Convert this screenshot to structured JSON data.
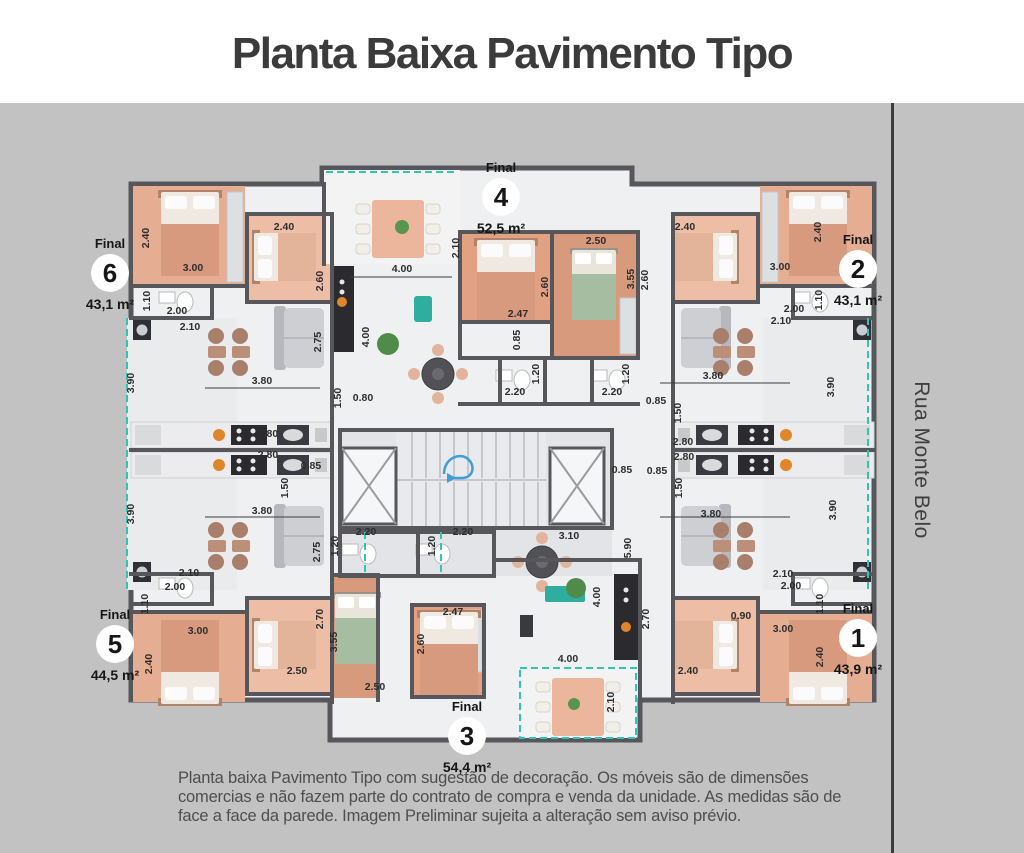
{
  "header": {
    "title": "Planta Baixa Pavimento Tipo"
  },
  "street": {
    "name": "Rua Monte Belo"
  },
  "disclaimer": {
    "text": "Planta baixa Pavimento Tipo com sugestão de decoração. Os móveis são de dimensões comercias e não fazem parte do contrato de compra e venda da unidade. As medidas são de face a face da parede. Imagem Preliminar sujeita a alteração sem aviso prévio."
  },
  "units": [
    {
      "label": "Final",
      "number": "1",
      "area": "43,9 m²"
    },
    {
      "label": "Final",
      "number": "2",
      "area": "43,1 m²"
    },
    {
      "label": "Final",
      "number": "3",
      "area": "54,4 m²"
    },
    {
      "label": "Final",
      "number": "4",
      "area": "52,5 m²"
    },
    {
      "label": "Final",
      "number": "5",
      "area": "44,5 m²"
    },
    {
      "label": "Final",
      "number": "6",
      "area": "43,1 m²"
    }
  ],
  "colors": {
    "background": "#c2c2c2",
    "header_background": "#ffffff",
    "title_text": "#3b3b3b",
    "wall": "#56565b",
    "floor": "#eef0f2",
    "bedroom_salmon": "#e5ad92",
    "dimension_teal": "#2cc6b4",
    "stairs_arrow_blue": "#3d9fd8",
    "disclaimer_text": "#4e4e4e"
  },
  "plan": {
    "dimensions": [
      {
        "t": "2.40",
        "x": 149,
        "y": 238,
        "v": true
      },
      {
        "t": "3.00",
        "x": 193,
        "y": 271
      },
      {
        "t": "2.40",
        "x": 284,
        "y": 230
      },
      {
        "t": "2.60",
        "x": 323,
        "y": 281,
        "v": true
      },
      {
        "t": "1.10",
        "x": 150,
        "y": 301,
        "v": true
      },
      {
        "t": "2.00",
        "x": 177,
        "y": 314
      },
      {
        "t": "2.10",
        "x": 190,
        "y": 330
      },
      {
        "t": "2.75",
        "x": 321,
        "y": 342,
        "v": true
      },
      {
        "t": "3.90",
        "x": 134,
        "y": 383,
        "v": true
      },
      {
        "t": "3.80",
        "x": 262,
        "y": 384
      },
      {
        "t": "0.80",
        "x": 363,
        "y": 401
      },
      {
        "t": "1.50",
        "x": 341,
        "y": 398,
        "v": true
      },
      {
        "t": "2.80",
        "x": 268,
        "y": 437
      },
      {
        "t": "2.80",
        "x": 268,
        "y": 458
      },
      {
        "t": "0.85",
        "x": 311,
        "y": 469
      },
      {
        "t": "1.50",
        "x": 288,
        "y": 488,
        "v": true
      },
      {
        "t": "3.90",
        "x": 134,
        "y": 514,
        "v": true
      },
      {
        "t": "3.80",
        "x": 262,
        "y": 514
      },
      {
        "t": "2.75",
        "x": 320,
        "y": 552,
        "v": true
      },
      {
        "t": "2.10",
        "x": 189,
        "y": 576
      },
      {
        "t": "2.00",
        "x": 175,
        "y": 590
      },
      {
        "t": "1.10",
        "x": 148,
        "y": 604,
        "v": true
      },
      {
        "t": "3.00",
        "x": 198,
        "y": 634
      },
      {
        "t": "2.40",
        "x": 152,
        "y": 664,
        "v": true
      },
      {
        "t": "2.50",
        "x": 297,
        "y": 674
      },
      {
        "t": "2.70",
        "x": 323,
        "y": 619,
        "v": true
      },
      {
        "t": "2.10",
        "x": 459,
        "y": 248,
        "v": true
      },
      {
        "t": "4.00",
        "x": 402,
        "y": 272
      },
      {
        "t": "4.00",
        "x": 369,
        "y": 337,
        "v": true
      },
      {
        "t": "2.47",
        "x": 518,
        "y": 317
      },
      {
        "t": "2.60",
        "x": 548,
        "y": 287,
        "v": true
      },
      {
        "t": "2.50",
        "x": 596,
        "y": 244
      },
      {
        "t": "3.55",
        "x": 634,
        "y": 279,
        "v": true
      },
      {
        "t": "0.85",
        "x": 520,
        "y": 340,
        "v": true
      },
      {
        "t": "1.20",
        "x": 539,
        "y": 374,
        "v": true
      },
      {
        "t": "2.20",
        "x": 515,
        "y": 395
      },
      {
        "t": "1.20",
        "x": 629,
        "y": 374,
        "v": true
      },
      {
        "t": "2.20",
        "x": 612,
        "y": 395
      },
      {
        "t": "1.20",
        "x": 338,
        "y": 546,
        "v": true
      },
      {
        "t": "2.20",
        "x": 366,
        "y": 535
      },
      {
        "t": "1.20",
        "x": 435,
        "y": 546,
        "v": true
      },
      {
        "t": "2.20",
        "x": 463,
        "y": 535
      },
      {
        "t": "3.10",
        "x": 569,
        "y": 539
      },
      {
        "t": "5.90",
        "x": 631,
        "y": 548,
        "v": true
      },
      {
        "t": "0.85",
        "x": 622,
        "y": 473
      },
      {
        "t": "4.00",
        "x": 600,
        "y": 597,
        "v": true
      },
      {
        "t": "4.00",
        "x": 568,
        "y": 662
      },
      {
        "t": "2.47",
        "x": 453,
        "y": 615
      },
      {
        "t": "2.60",
        "x": 424,
        "y": 644,
        "v": true
      },
      {
        "t": "2.50",
        "x": 375,
        "y": 690
      },
      {
        "t": "3.55",
        "x": 337,
        "y": 642,
        "v": true
      },
      {
        "t": "2.10",
        "x": 614,
        "y": 702,
        "v": true
      },
      {
        "t": "2.40",
        "x": 685,
        "y": 230
      },
      {
        "t": "2.60",
        "x": 648,
        "y": 280,
        "v": true
      },
      {
        "t": "3.00",
        "x": 780,
        "y": 270
      },
      {
        "t": "2.40",
        "x": 821,
        "y": 232,
        "v": true
      },
      {
        "t": "1.10",
        "x": 822,
        "y": 300,
        "v": true
      },
      {
        "t": "2.00",
        "x": 794,
        "y": 312
      },
      {
        "t": "2.10",
        "x": 781,
        "y": 324
      },
      {
        "t": "3.80",
        "x": 713,
        "y": 379
      },
      {
        "t": "3.90",
        "x": 834,
        "y": 387,
        "v": true
      },
      {
        "t": "0.85",
        "x": 656,
        "y": 404
      },
      {
        "t": "1.50",
        "x": 681,
        "y": 413,
        "v": true
      },
      {
        "t": "2.80",
        "x": 683,
        "y": 445
      },
      {
        "t": "2.80",
        "x": 684,
        "y": 460
      },
      {
        "t": "0.85",
        "x": 657,
        "y": 474
      },
      {
        "t": "1.50",
        "x": 682,
        "y": 488,
        "v": true
      },
      {
        "t": "3.80",
        "x": 711,
        "y": 517
      },
      {
        "t": "3.90",
        "x": 836,
        "y": 510,
        "v": true
      },
      {
        "t": "2.10",
        "x": 783,
        "y": 577
      },
      {
        "t": "2.00",
        "x": 791,
        "y": 589
      },
      {
        "t": "1.10",
        "x": 823,
        "y": 604,
        "v": true
      },
      {
        "t": "0.90",
        "x": 741,
        "y": 619
      },
      {
        "t": "3.00",
        "x": 783,
        "y": 632
      },
      {
        "t": "2.40",
        "x": 823,
        "y": 657,
        "v": true
      },
      {
        "t": "2.70",
        "x": 649,
        "y": 619,
        "v": true
      },
      {
        "t": "2.40",
        "x": 688,
        "y": 674
      }
    ]
  }
}
